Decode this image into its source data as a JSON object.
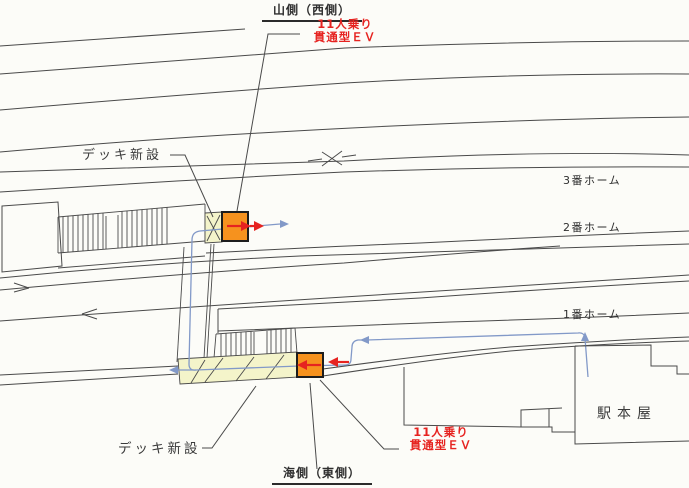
{
  "drawing": {
    "orientation": {
      "top": "山側（西側）",
      "bottom": "海側（東側）"
    },
    "annotations": {
      "deck_new_upper": "デッキ新設",
      "deck_new_lower": "デッキ新設",
      "ev_upper": {
        "line1": "11人乗り",
        "line2": "貫通型ＥＶ"
      },
      "ev_lower": {
        "line1": "11人乗り",
        "line2": "貫通型ＥＶ"
      }
    },
    "platforms": {
      "platform_3": "3番ホーム",
      "platform_2": "2番ホーム",
      "platform_1": "1番ホーム"
    },
    "station_building": "駅本屋",
    "colors": {
      "ev_fill": "#F6921E",
      "deck_fill": "#F4F4CA",
      "flow_line_blue": "#8299C8",
      "annotation_red": "#E62320",
      "line_gray": "#4A4A4A"
    }
  }
}
